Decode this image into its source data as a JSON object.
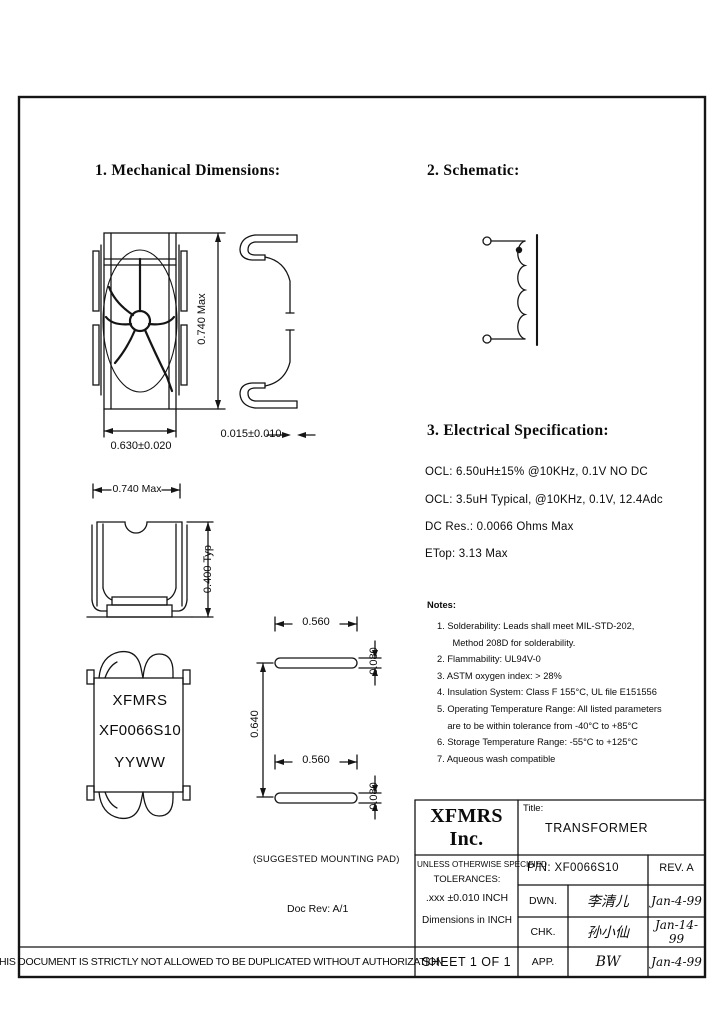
{
  "headings": {
    "mechanical": "1. Mechanical Dimensions:",
    "schematic": "2. Schematic:",
    "electrical": "3. Electrical Specification:"
  },
  "electrical": {
    "lines": [
      "OCL: 6.50uH±15% @10KHz, 0.1V NO DC",
      "OCL: 3.5uH Typical, @10KHz, 0.1V, 12.4Adc",
      "DC Res.: 0.0066 Ohms Max",
      "ETop:  3.13 Max"
    ]
  },
  "notes": {
    "heading": "Notes:",
    "lines": [
      "1. Solderability: Leads shall meet MIL-STD-202,",
      "      Method 208D for solderability.",
      "2. Flammability: UL94V-0",
      "3. ASTM oxygen index: > 28%",
      "4. Insulation System: Class F 155°C, UL file E151556",
      "5. Operating Temperature Range: All listed parameters",
      "    are to be within tolerance from -40°C to +85°C",
      "6. Storage Temperature Range: -55°C to +125°C",
      "7. Aqueous wash compatible"
    ]
  },
  "dimensions": {
    "top_view_width": "0.630±0.020",
    "top_view_height": "0.740 Max",
    "side_view_gap": "0.015±0.010",
    "front_view_width": "0.740 Max",
    "front_view_height": "0.400 Typ",
    "pad_width_top": "0.560",
    "pad_width_bottom": "0.560",
    "pad_height_top": "0.080",
    "pad_height_bottom": "0.080",
    "pad_pitch": "0.640"
  },
  "marking": {
    "line1": "XFMRS",
    "line2": "XF0066S10",
    "line3": "YYWW"
  },
  "captions": {
    "mounting_pad": "(SUGGESTED MOUNTING PAD)",
    "doc_rev": "Doc Rev: A/1"
  },
  "title_block": {
    "company": "XFMRS Inc.",
    "title_label": "Title:",
    "title": "TRANSFORMER",
    "tolerance_lines": [
      "UNLESS OTHERWISE SPECIFIED",
      "TOLERANCES:",
      ".xxx ±0.010 INCH",
      "Dimensions in INCH"
    ],
    "part_number": "P/N: XF0066S10",
    "revision": "REV. A",
    "rows": [
      {
        "label": "DWN.",
        "signature": "李清儿",
        "date": "Jan-4-99"
      },
      {
        "label": "CHK.",
        "signature": "孙小仙",
        "date": "Jan-14-99"
      },
      {
        "label": "APP.",
        "signature": "BW",
        "date": "Jan-4-99"
      }
    ],
    "sheet": "SHEET 1 OF 1"
  },
  "footer": {
    "disclaimer": "THIS DOCUMENT IS STRICTLY NOT ALLOWED TO BE DUPLICATED WITHOUT AUTHORIZATION"
  }
}
